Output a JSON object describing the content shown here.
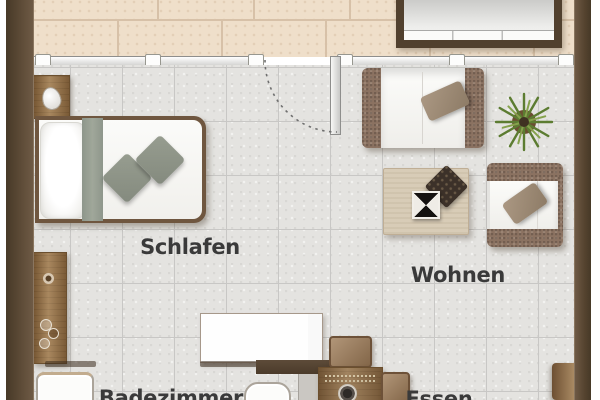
{
  "rooms": {
    "schlafen": {
      "label": "Schlafen"
    },
    "wohnen": {
      "label": "Wohnen"
    },
    "badezimmer": {
      "label": "Badezimmer"
    },
    "essen": {
      "label": "Essen"
    }
  },
  "furniture": [
    "nightstand",
    "table-lamp",
    "double-bed",
    "bed-cushions",
    "sideboard",
    "lowboard",
    "bathtub",
    "toilet",
    "sofa",
    "sofa-pillow",
    "potted-plant",
    "armchair",
    "armchair-pillow",
    "coffee-table",
    "decor-tray",
    "decor-bowl",
    "dining-table",
    "dining-chairs",
    "balcony-door",
    "window-wall",
    "bay-window-structure"
  ],
  "colors": {
    "wall": "#55432f",
    "balcony_tile": "#efdfca",
    "tile_joint": "#d7c1a8",
    "floor": "#e4e3e0",
    "floor_grid": "#c8c7c5",
    "wood": "#96734a",
    "wicker_frame": "#8b7261",
    "cushion_white": "#fbfbf9",
    "pillow_taupe": "#9c8974",
    "sage_gray": "#8e968b",
    "plant_green": "#5c7c31",
    "label_text": "#3a3a3a"
  }
}
